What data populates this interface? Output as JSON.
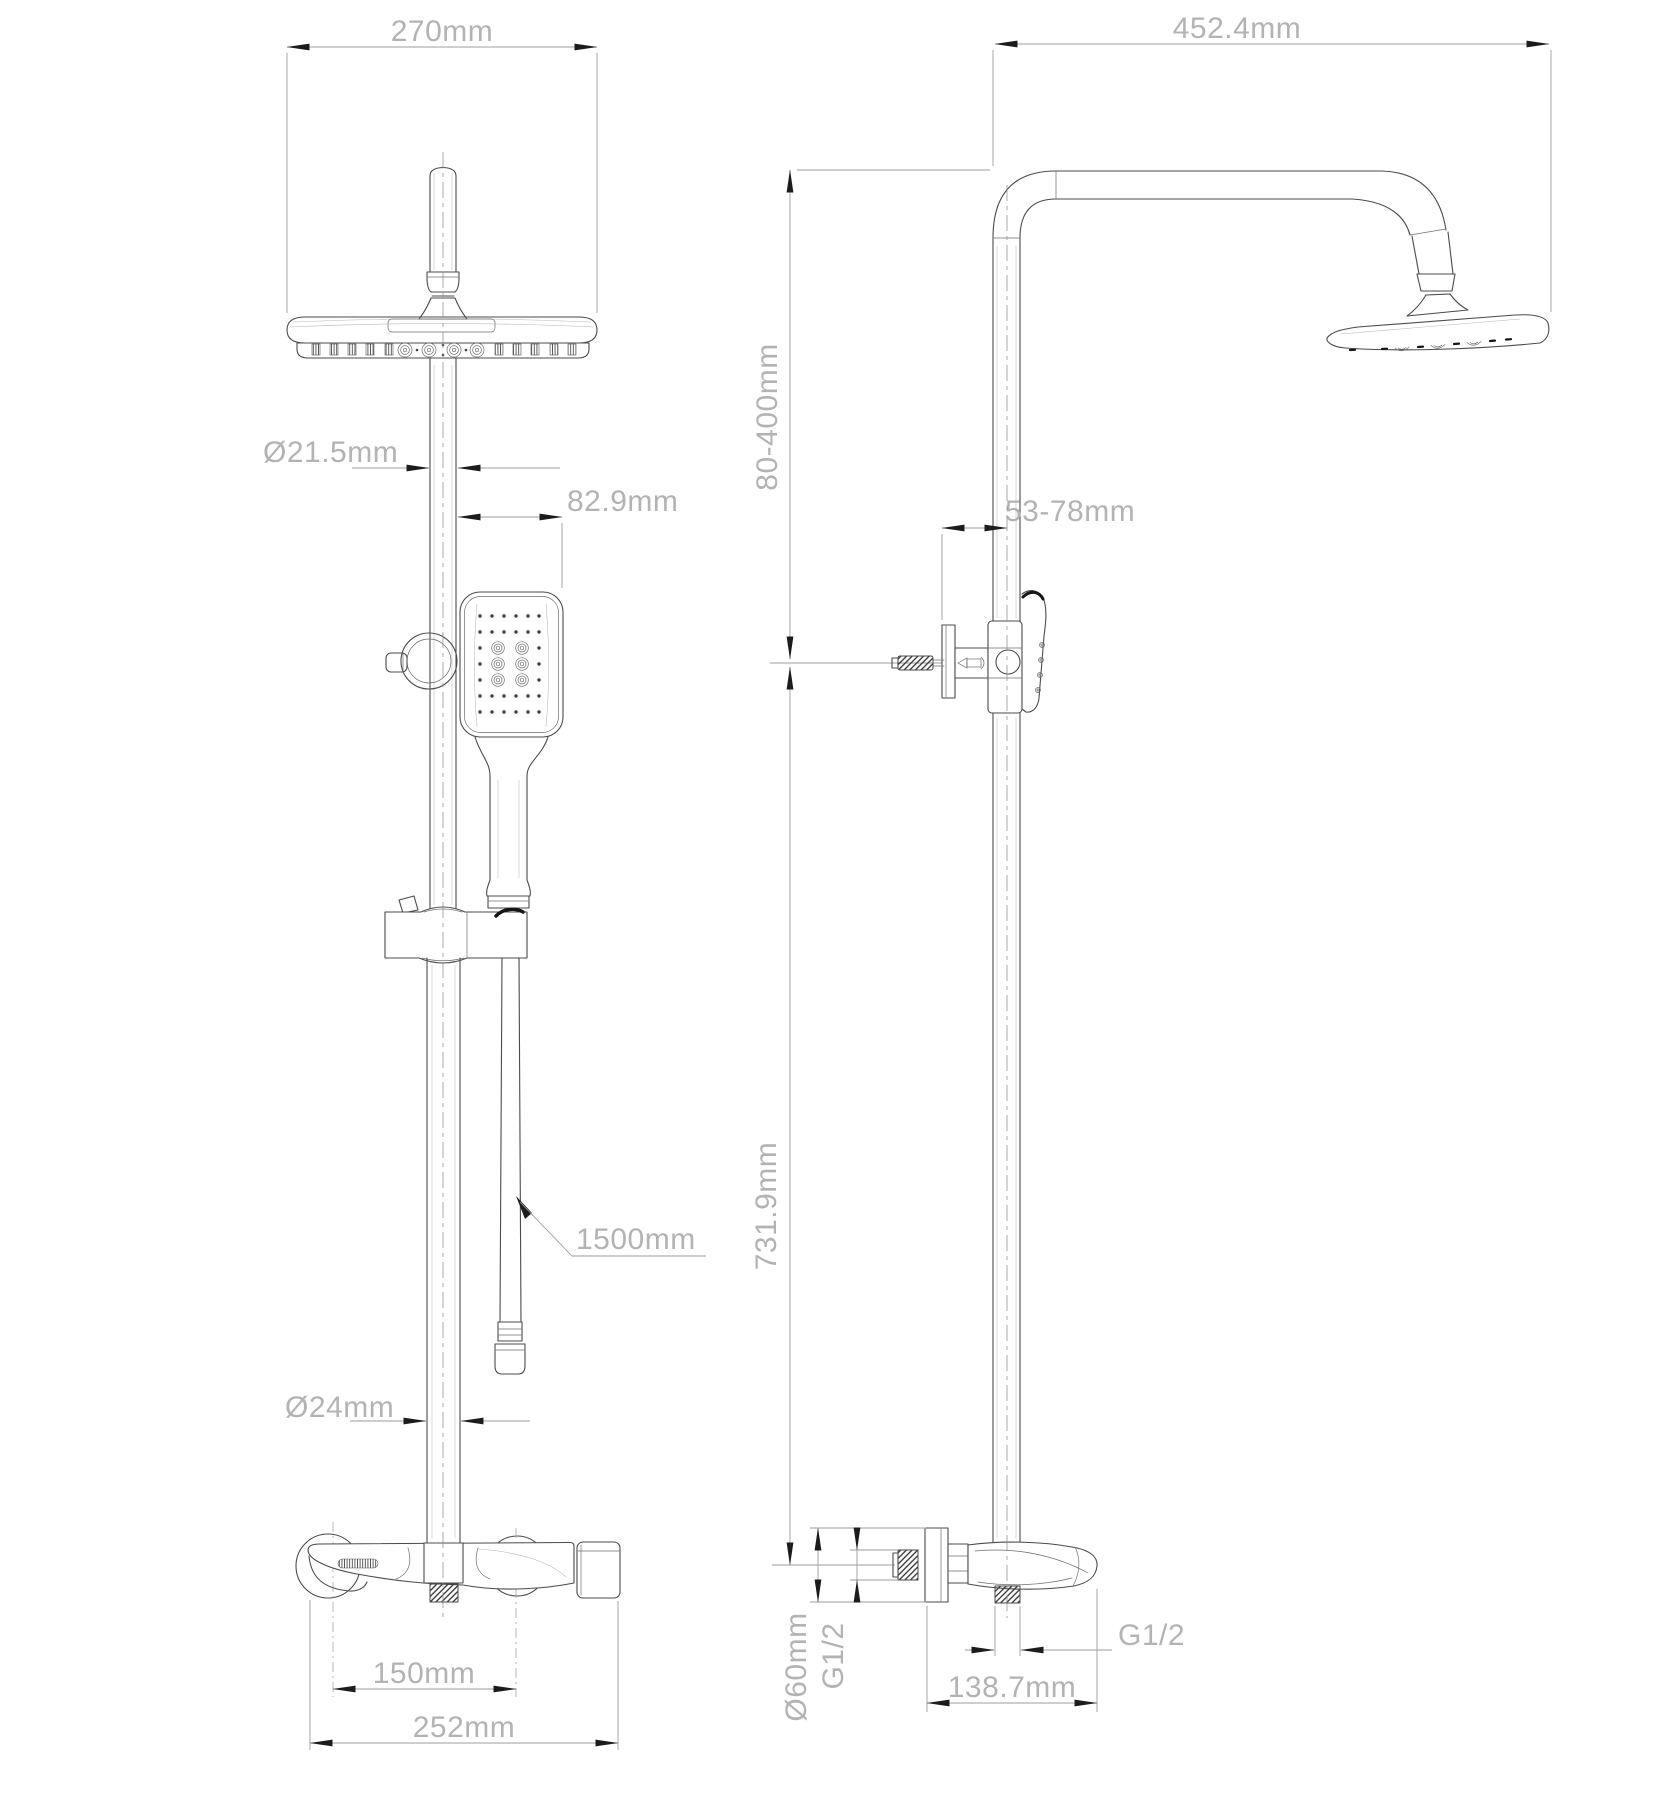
{
  "drawing": {
    "title": "shower-system-technical-drawing",
    "front_view": {
      "dim_head_width": "270mm",
      "dim_upper_pipe_diameter": "Ø21.5mm",
      "dim_handshower_offset": "82.9mm",
      "dim_hose_length": "1500mm",
      "dim_lower_pipe_diameter": "Ø24mm",
      "dim_inlet_spacing": "150mm",
      "dim_mixer_width": "252mm"
    },
    "side_view": {
      "dim_arm_reach": "452.4mm",
      "dim_upper_height_range": "80-400mm",
      "dim_wall_clearance": "53-78mm",
      "dim_lower_height": "731.9mm",
      "dim_flange_diameter": "Ø60mm",
      "dim_inlet_thread": "G1/2",
      "dim_outlet_thread": "G1/2",
      "dim_spout_depth": "138.7mm"
    },
    "colors": {
      "line": "#4b4b4b",
      "dim": "#9d9d9d",
      "text": "#b3b3b3",
      "arrow": "#1c1c1c"
    }
  }
}
